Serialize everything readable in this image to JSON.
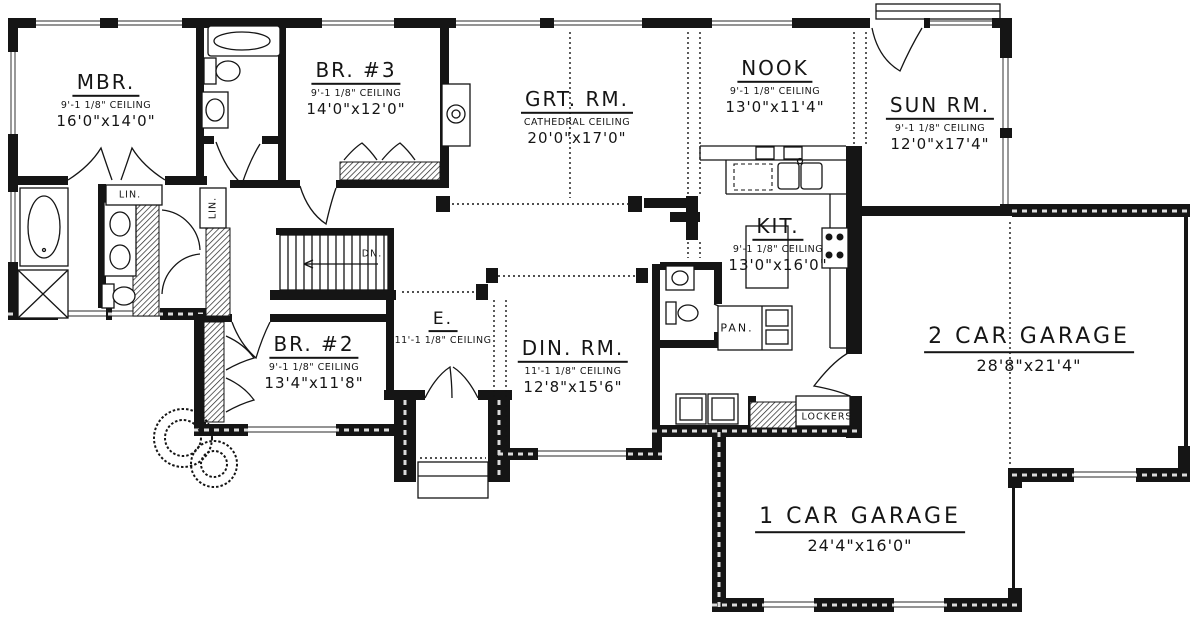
{
  "rooms": {
    "mbr": {
      "name": "MBR.",
      "ceiling": "9'-1 1/8\" CEILING",
      "size": "16'0\"x14'0\""
    },
    "br3": {
      "name": "BR. #3",
      "ceiling": "9'-1 1/8\" CEILING",
      "size": "14'0\"x12'0\""
    },
    "grt": {
      "name": "GRT. RM.",
      "ceiling": "CATHEDRAL CEILING",
      "size": "20'0\"x17'0\""
    },
    "nook": {
      "name": "NOOK",
      "ceiling": "9'-1 1/8\" CEILING",
      "size": "13'0\"x11'4\""
    },
    "sun": {
      "name": "SUN RM.",
      "ceiling": "9'-1 1/8\" CEILING",
      "size": "12'0\"x17'4\""
    },
    "kit": {
      "name": "KIT.",
      "ceiling": "9'-1 1/8\" CEILING",
      "size": "13'0\"x16'0\""
    },
    "br2": {
      "name": "BR. #2",
      "ceiling": "9'-1 1/8\" CEILING",
      "size": "13'4\"x11'8\""
    },
    "entry": {
      "name": "E.",
      "ceiling": "11'-1 1/8\" CEILING"
    },
    "din": {
      "name": "DIN. RM.",
      "ceiling": "11'-1 1/8\" CEILING",
      "size": "12'8\"x15'6\""
    },
    "garage2": {
      "name": "2 CAR GARAGE",
      "size": "28'8\"x21'4\""
    },
    "garage1": {
      "name": "1 CAR GARAGE",
      "size": "24'4\"x16'0\""
    }
  },
  "labels": {
    "linen": "LIN.",
    "linen2": "LIN.",
    "down": "DN.",
    "pantry": "PAN.",
    "lockers": "LOCKERS"
  },
  "colors": {
    "ink": "#151515",
    "paper": "#ffffff"
  }
}
